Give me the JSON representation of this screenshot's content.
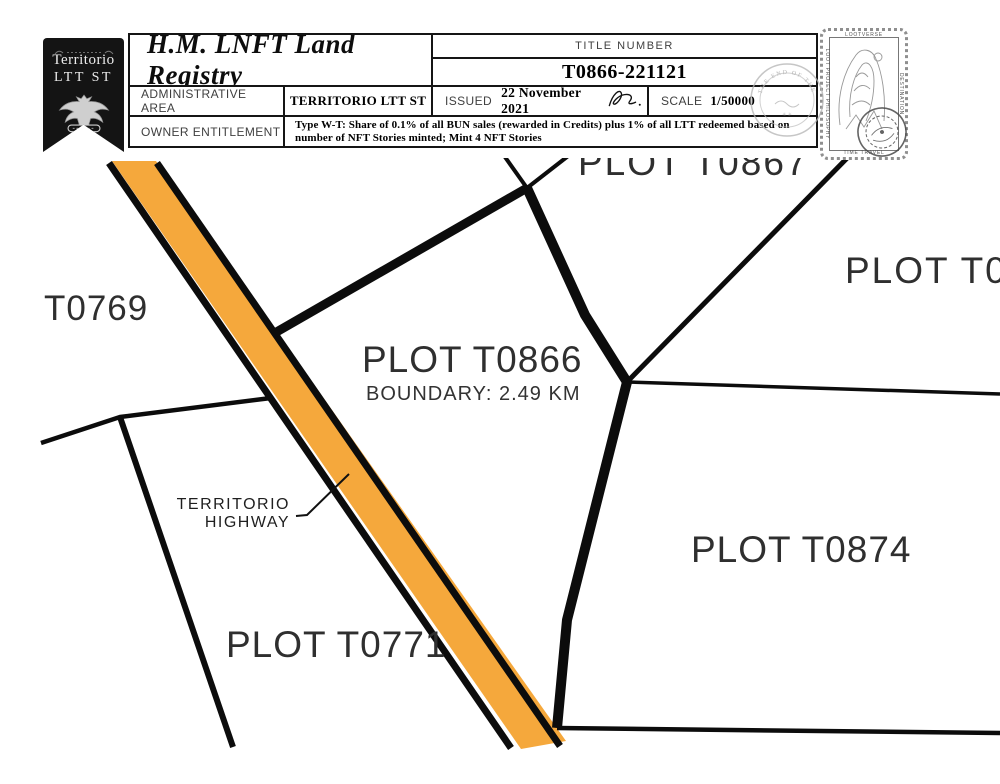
{
  "certificate": {
    "banner": {
      "title_line1": "Territorio",
      "title_line2": "LTT ST"
    },
    "header": {
      "title": "H.M. LNFT Land Registry",
      "title_number_label": "TITLE NUMBER",
      "title_number": "T0866-221121",
      "admin_area_label": "ADMINISTRATIVE AREA",
      "admin_area_value": "TERRITORIO LTT ST",
      "issued_label": "ISSUED",
      "issued_date": "22 November 2021",
      "scale_label": "SCALE",
      "scale_value": "1/50000",
      "owner_label": "OWNER ENTITLEMENT",
      "owner_entitlement": "Type W-T: Share of 0.1% of all BUN sales (rewarded in Credits) plus 1% of all LTT redeemed based on number of NFT Stories minted; Mint 4 NFT Stories",
      "seal_text": "THE END OF THE WORLD"
    },
    "stamp": {
      "top_text": "LOOTVERSE",
      "right_text": "DESTINATION",
      "left_text": "LOOT PROJECT PHILOSOPHY",
      "bottom_text": "TIME TRAVEL"
    }
  },
  "map": {
    "labels": {
      "plot_t0867": "PLOT T0867",
      "plot_right_partial": "PLOT T08",
      "t0769": "T0769",
      "plot_t0866": "PLOT T0866",
      "plot_t0866_boundary": "BOUNDARY: 2.49 KM",
      "plot_t0874": "PLOT T0874",
      "plot_t0771": "PLOT T0771",
      "highway_line1": "TERRITORIO",
      "highway_line2": "HIGHWAY"
    },
    "colors": {
      "highway_fill": "#F5A83C",
      "boundary_line": "#0c0c0c"
    }
  }
}
